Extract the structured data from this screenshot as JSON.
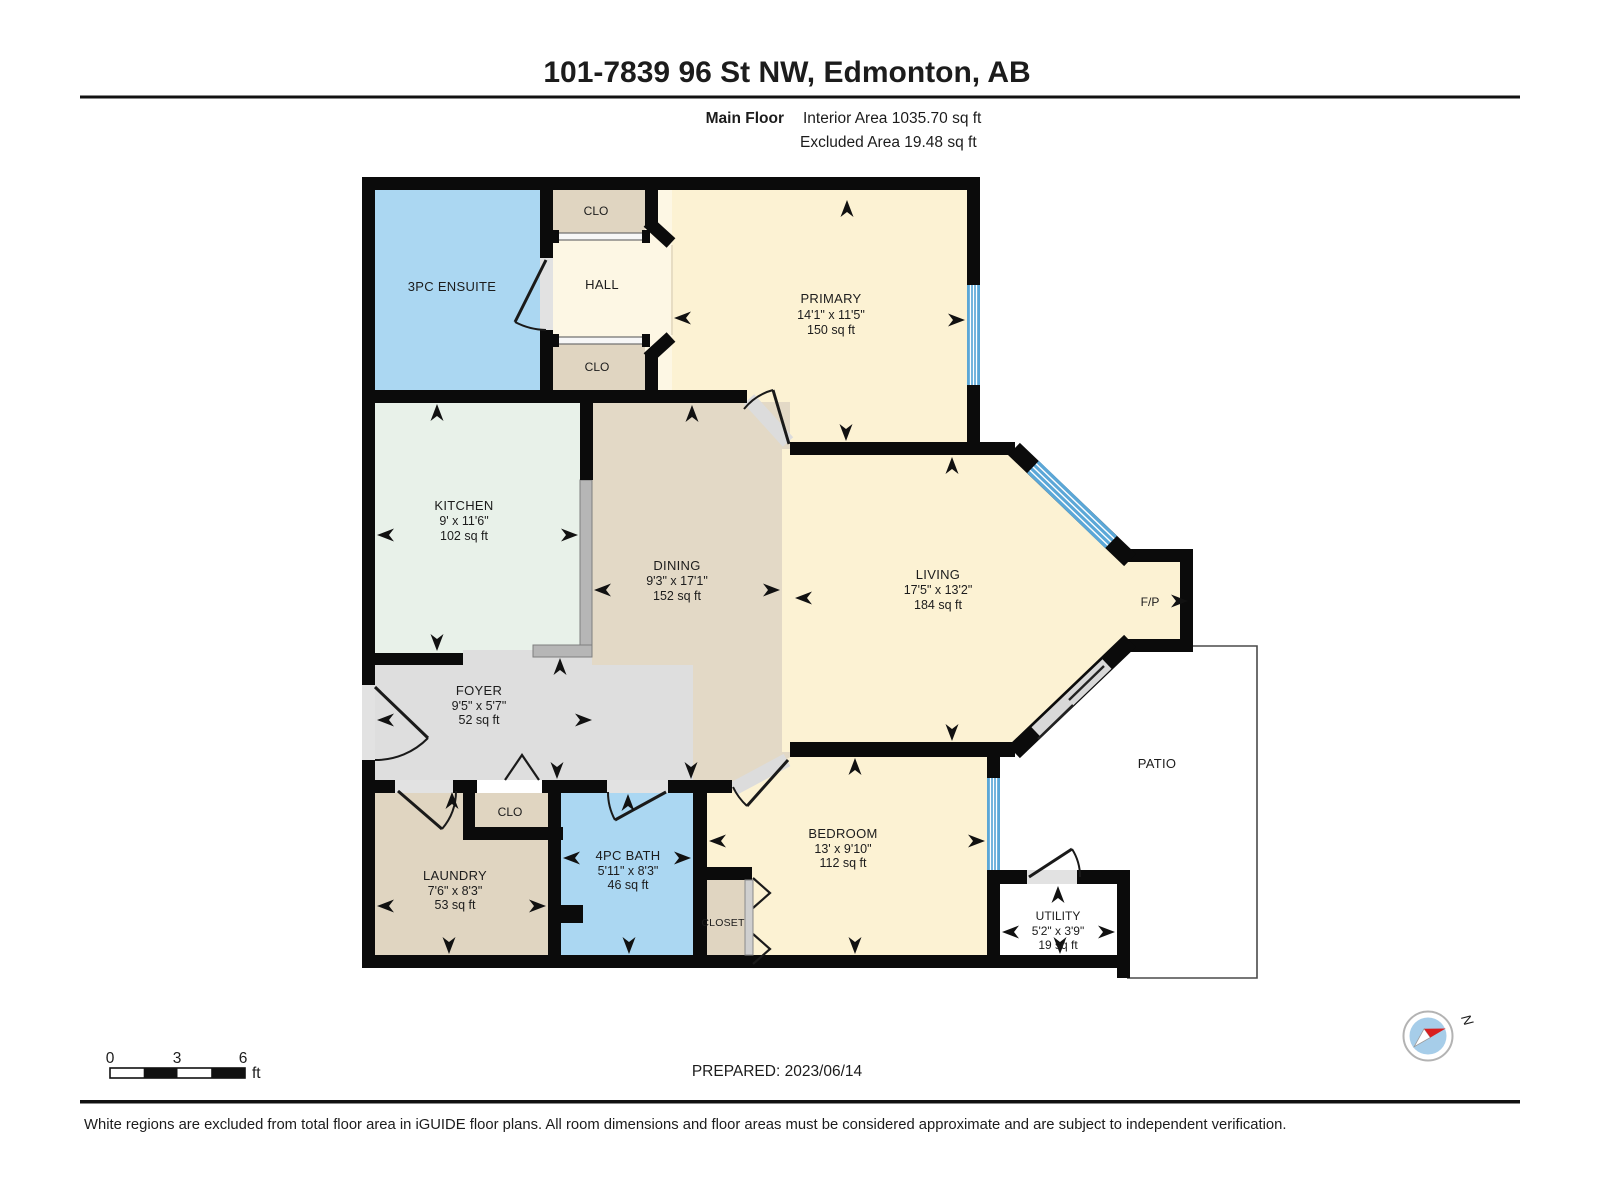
{
  "header": {
    "title": "101-7839 96 St NW, Edmonton, AB",
    "floor_label": "Main Floor",
    "interior_area": "Interior Area 1035.70 sq ft",
    "excluded_area": "Excluded Area 19.48 sq ft"
  },
  "plan": {
    "rooms": {
      "ensuite": {
        "name": "3PC ENSUITE"
      },
      "clo_top": {
        "name": "CLO"
      },
      "hall": {
        "name": "HALL"
      },
      "clo_bottom": {
        "name": "CLO"
      },
      "primary": {
        "name": "PRIMARY",
        "dims": "14'1\" x 11'5\"",
        "area": "150 sq ft"
      },
      "kitchen": {
        "name": "KITCHEN",
        "dims": "9' x 11'6\"",
        "area": "102 sq ft"
      },
      "dining": {
        "name": "DINING",
        "dims": "9'3\" x 17'1\"",
        "area": "152 sq ft"
      },
      "living": {
        "name": "LIVING",
        "dims": "17'5\" x 13'2\"",
        "area": "184 sq ft"
      },
      "fireplace": {
        "name": "F/P"
      },
      "foyer": {
        "name": "FOYER",
        "dims": "9'5\" x 5'7\"",
        "area": "52 sq ft"
      },
      "clo_foyer": {
        "name": "CLO"
      },
      "laundry": {
        "name": "LAUNDRY",
        "dims": "7'6\" x 8'3\"",
        "area": "53 sq ft"
      },
      "bath": {
        "name": "4PC BATH",
        "dims": "5'11\" x 8'3\"",
        "area": "46 sq ft"
      },
      "closet": {
        "name": "CLOSET"
      },
      "bedroom": {
        "name": "BEDROOM",
        "dims": "13' x 9'10\"",
        "area": "112 sq ft"
      },
      "utility": {
        "name": "UTILITY",
        "dims": "5'2\" x 3'9\"",
        "area": "19 sq ft"
      },
      "patio": {
        "name": "PATIO"
      }
    }
  },
  "scale_bar": {
    "start": "0",
    "mid": "3",
    "end": "6",
    "unit": "ft"
  },
  "prepared": "PREPARED: 2023/06/14",
  "disclaimer": "White regions are excluded from total floor area in iGUIDE floor plans. All room dimensions and floor areas must be considered approximate and are subject to independent verification.",
  "compass": {
    "north_label": "N"
  },
  "colors": {
    "wall": "#0b0b0b",
    "window": "#5ba7d7",
    "cream_room": "#fcf2d3",
    "hall_room": "#fdf7e4",
    "tan_room": "#e0d5c1",
    "dining_room": "#e3d9c6",
    "kitchen_room": "#e8f1e9",
    "foyer_room": "#dedede",
    "wet_room_blue": "#abd7f2",
    "compass_needle_red": "#d91f1f"
  }
}
